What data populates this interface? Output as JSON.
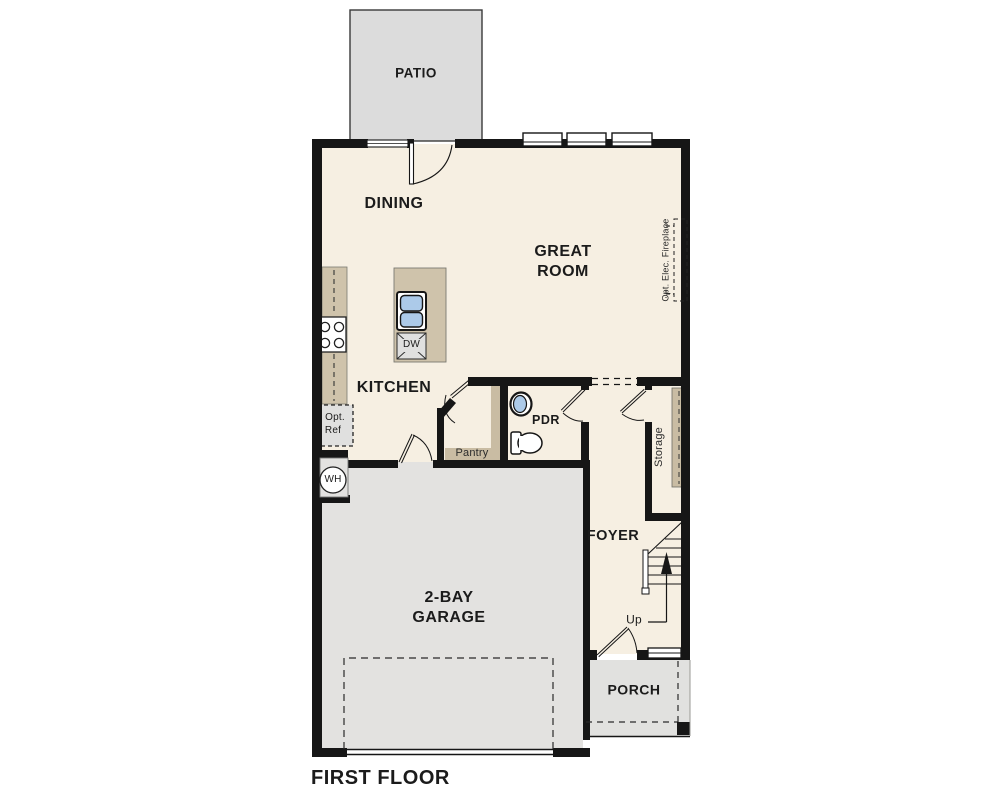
{
  "plan": {
    "title": "FIRST FLOOR",
    "rooms": {
      "patio": "PATIO",
      "dining": "DINING",
      "great_room": "GREAT ROOM",
      "kitchen": "KITCHEN",
      "pdr": "PDR",
      "pantry": "Pantry",
      "storage": "Storage",
      "foyer": "FOYER",
      "garage": "2-BAY GARAGE",
      "porch": "PORCH"
    },
    "annotations": {
      "up": "Up",
      "water_heater": "WH",
      "dishwasher": "DW",
      "opt_ref_line1": "Opt.",
      "opt_ref_line2": "Ref",
      "opt_fireplace": "Opt. Elec. Fireplace"
    },
    "colors": {
      "wall": "#161616",
      "floor": "#F6EFE2",
      "patio_concrete": "#DCDCDC",
      "garage_concrete": "#E3E2E0",
      "porch_concrete": "#E1E1DF",
      "counter_tan": "#CFC3AB",
      "shelf_tan": "#C9BCA3",
      "sink_blue": "#ACCAE9",
      "appliance_gray": "#E0E0DF"
    }
  }
}
